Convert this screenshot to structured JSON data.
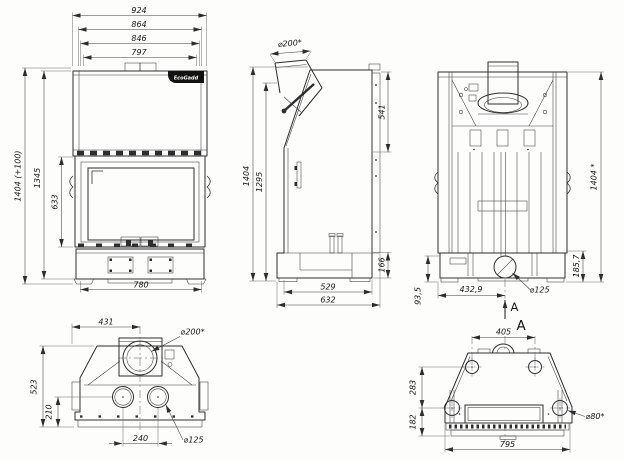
{
  "brand": {
    "logo_text": "EcoGadd"
  },
  "views": {
    "front": {
      "w924": "924",
      "w864": "864",
      "w846": "846",
      "w797": "797",
      "h_total": "1404 (+100)",
      "h1345": "1345",
      "h633": "633",
      "w780": "780"
    },
    "side": {
      "flue_d": "⌀200*",
      "h541": "541",
      "h1404": "1404",
      "h1295": "1295",
      "h166": "166",
      "w529": "529",
      "w632": "632"
    },
    "rear": {
      "h1404": "1404 *",
      "h185_7": "185,7",
      "h93_5": "93,5",
      "w432_9": "432,9",
      "d125": "⌀125",
      "section": "A"
    },
    "top": {
      "w431": "431",
      "flue_d": "⌀200*",
      "h523": "523",
      "h210": "210",
      "w240": "240",
      "d125": "⌀125"
    },
    "bottom": {
      "w405": "405",
      "h283": "283",
      "h182": "182",
      "w795": "795",
      "d80": "⌀80*",
      "section": "A"
    }
  }
}
